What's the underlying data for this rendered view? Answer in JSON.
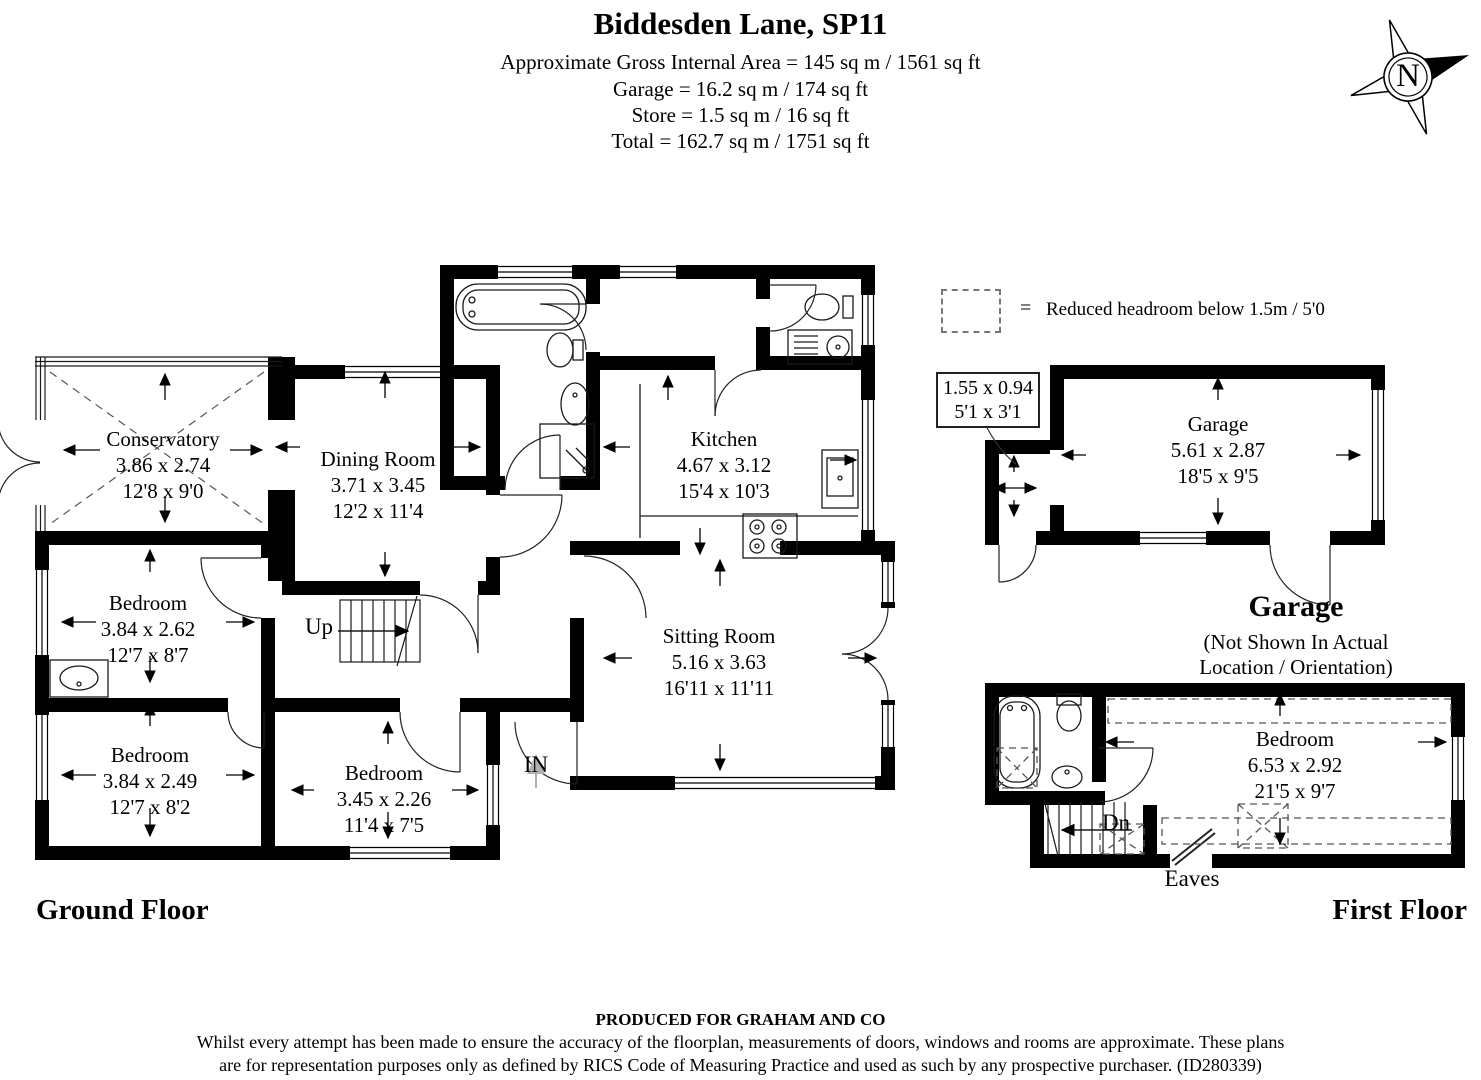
{
  "header": {
    "title": "Biddesden Lane, SP11",
    "line1": "Approximate Gross Internal Area = 145 sq m / 1561 sq ft",
    "line2": "Garage = 16.2 sq m / 174 sq ft",
    "line3": "Store = 1.5 sq m / 16 sq ft",
    "line4": "Total = 162.7 sq m / 1751 sq ft"
  },
  "compass": {
    "label": "N"
  },
  "legend": {
    "equals": "=",
    "text": "Reduced headroom below 1.5m / 5'0"
  },
  "rooms": {
    "conservatory": {
      "name": "Conservatory",
      "metric": "3.86 x 2.74",
      "imperial": "12'8 x 9'0"
    },
    "dining": {
      "name": "Dining Room",
      "metric": "3.71 x 3.45",
      "imperial": "12'2 x 11'4"
    },
    "kitchen": {
      "name": "Kitchen",
      "metric": "4.67 x 3.12",
      "imperial": "15'4 x 10'3"
    },
    "sitting": {
      "name": "Sitting Room",
      "metric": "5.16 x 3.63",
      "imperial": "16'11 x 11'11"
    },
    "bedroom1": {
      "name": "Bedroom",
      "metric": "3.84 x 2.62",
      "imperial": "12'7 x 8'7"
    },
    "bedroom2": {
      "name": "Bedroom",
      "metric": "3.84 x 2.49",
      "imperial": "12'7 x 8'2"
    },
    "bedroom3": {
      "name": "Bedroom",
      "metric": "3.45 x 2.26",
      "imperial": "11'4 x 7'5"
    },
    "garage": {
      "name": "Garage",
      "metric": "5.61 x 2.87",
      "imperial": "18'5 x 9'5"
    },
    "store": {
      "metric": "1.55 x 0.94",
      "imperial": "5'1 x 3'1"
    },
    "ff_bedroom": {
      "name": "Bedroom",
      "metric": "6.53 x 2.92",
      "imperial": "21'5 x 9'7"
    }
  },
  "labels": {
    "up": "Up",
    "in": "IN",
    "dn": "Dn",
    "eaves": "Eaves",
    "ground_floor": "Ground Floor",
    "first_floor": "First Floor",
    "garage_heading": "Garage",
    "garage_note1": "(Not Shown In Actual",
    "garage_note2": "Location / Orientation)"
  },
  "footer": {
    "produced": "PRODUCED FOR GRAHAM AND CO",
    "disclaimer1": "Whilst every attempt has been made to ensure the accuracy of the floorplan, measurements of doors, windows and rooms are approximate. These plans",
    "disclaimer2": "are for representation purposes only as defined by RICS Code of Measuring Practice and used as such by any prospective purchaser. (ID280339)"
  },
  "colors": {
    "wall": "#000000",
    "thin_line": "#1a1a1a",
    "dashed": "#555555",
    "gray_arrow": "#b0b0b0"
  }
}
